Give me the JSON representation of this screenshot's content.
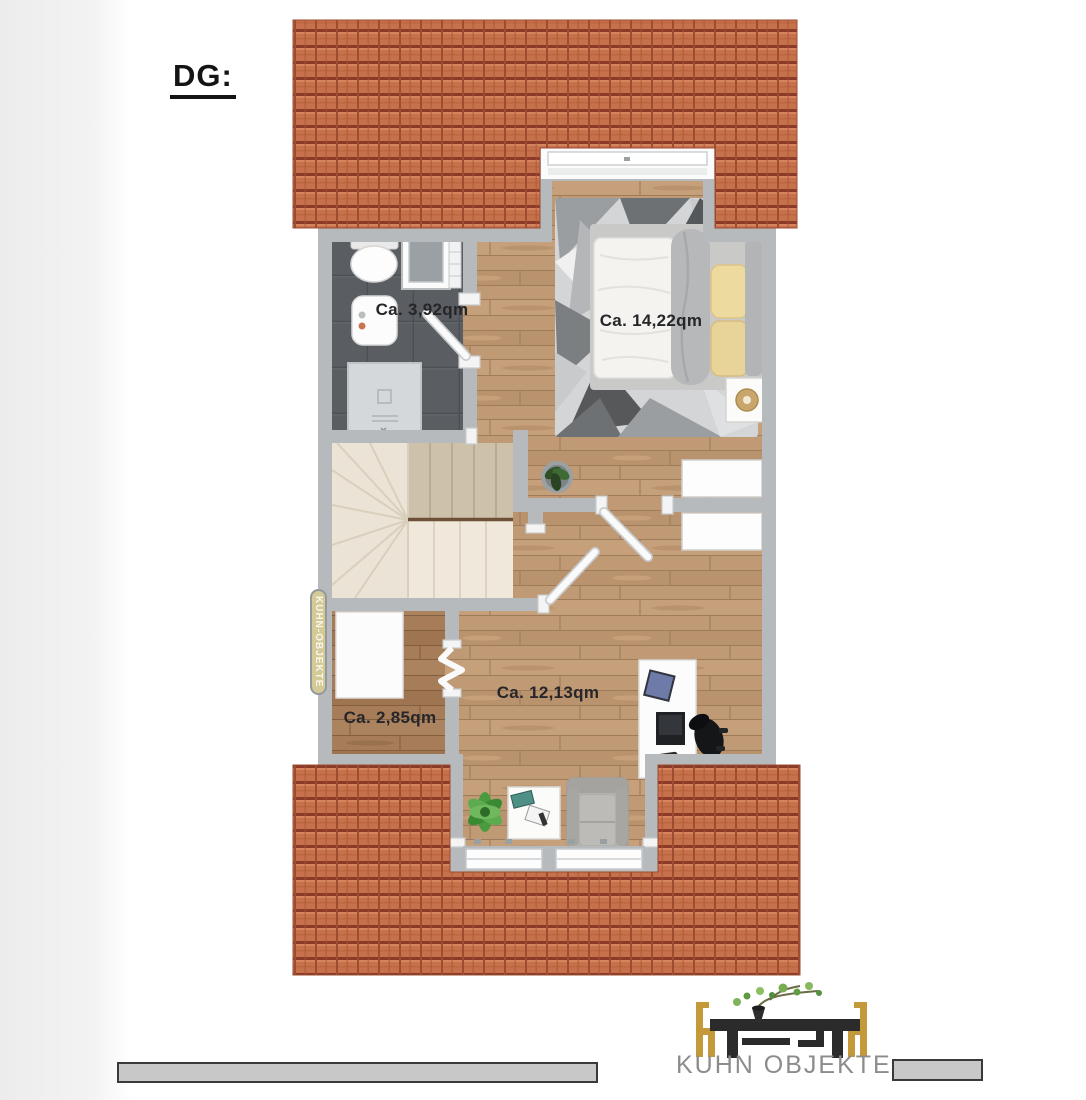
{
  "page": {
    "title": "DG:"
  },
  "floorplan": {
    "watermark": "KUHN-OBJEKTE",
    "rooms": [
      {
        "name": "bathroom",
        "area_label": "Ca. 3,92qm"
      },
      {
        "name": "bedroom",
        "area_label": "Ca. 14,22qm"
      },
      {
        "name": "storage",
        "area_label": "Ca. 2,85qm"
      },
      {
        "name": "living",
        "area_label": "Ca. 12,13qm"
      }
    ]
  },
  "footer": {
    "brand": "KUHN OBJEKTE"
  },
  "colors": {
    "roof_tile": "#c7714c",
    "roof_line": "#8a3a26",
    "wall": "#b6babc",
    "wood_main": "#c09a74",
    "wood_dark": "#a67d58",
    "bath_tile": "#5a5e62",
    "stairs": "#ebe3d5",
    "chair_gold": "#c39939",
    "brand_gray": "#8c8c8c",
    "watermark_bg": "#d3ca97"
  }
}
